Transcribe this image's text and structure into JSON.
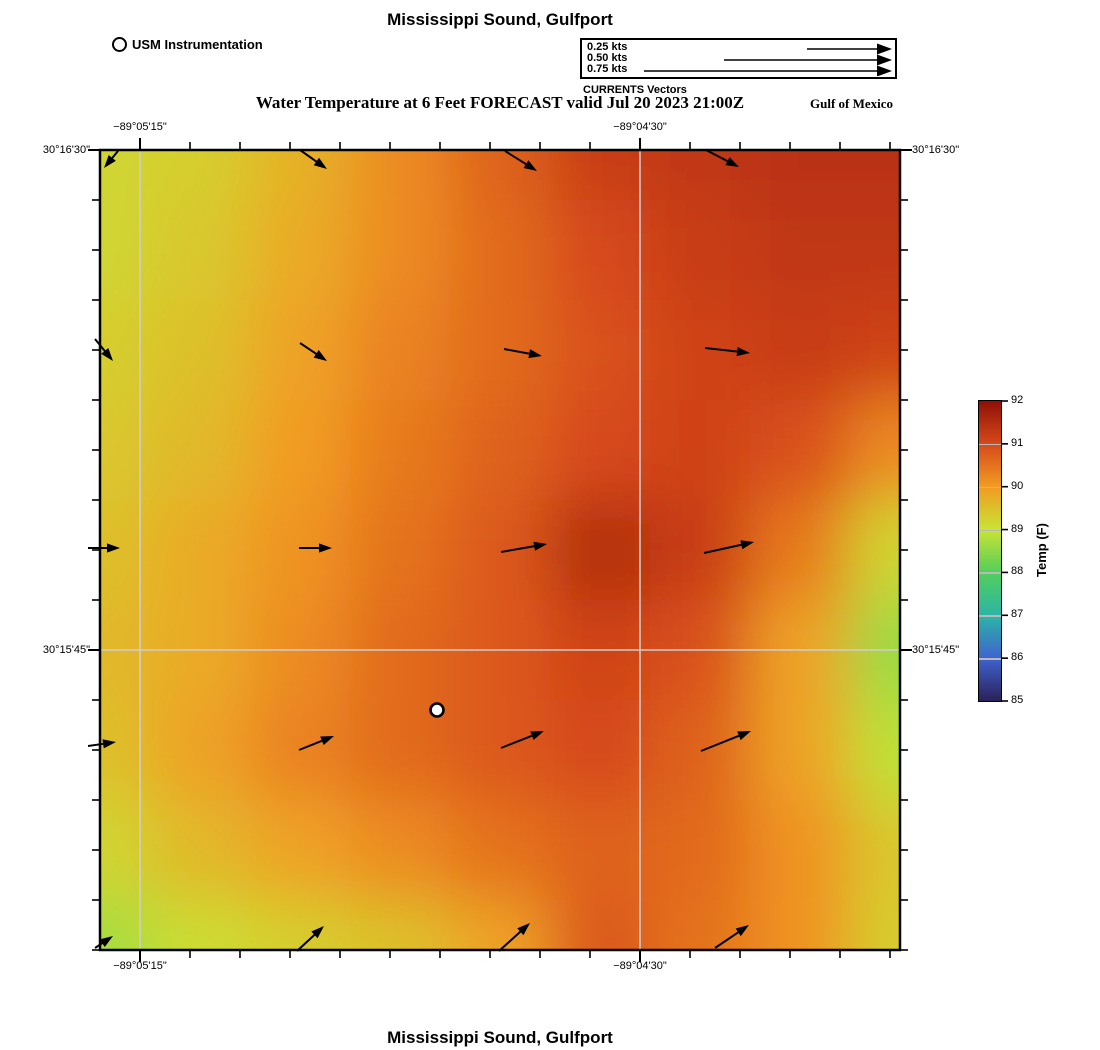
{
  "page": {
    "top_title": "Mississippi Sound, Gulfport",
    "subtitle": "Water Temperature at 6 Feet FORECAST valid Jul 20 2023 21:00Z",
    "gulf_label": "Gulf of Mexico",
    "bottom_title": "Mississippi Sound, Gulfport"
  },
  "station_legend": {
    "label": "USM Instrumentation"
  },
  "currents_legend": {
    "caption": "CURRENTS Vectors",
    "entries": [
      {
        "label": "0.25 kts",
        "tail_x": 225,
        "head_x": 310,
        "y": 9
      },
      {
        "label": "0.50 kts",
        "tail_x": 142,
        "head_x": 310,
        "y": 20
      },
      {
        "label": "0.75 kts",
        "tail_x": 62,
        "head_x": 310,
        "y": 31
      }
    ]
  },
  "axes": {
    "x_labels": [
      {
        "label": "−89°05'15\"",
        "px": 40
      },
      {
        "label": "−89°04'30\"",
        "px": 540
      }
    ],
    "y_labels": [
      {
        "label": "30°16'30\"",
        "px": 0
      },
      {
        "label": "30°15'45\"",
        "px": 500
      }
    ]
  },
  "chart_data": {
    "type": "heatmap",
    "title": "Water Temperature at 6 Feet FORECAST valid Jul 20 2023 21:00Z",
    "region": "Mississippi Sound, Gulfport",
    "units": "°F",
    "plot_px": 800,
    "grid_spacing_px": 100,
    "temperature_grid_F": [
      [
        89.2,
        89.3,
        89.7,
        90.2,
        90.7,
        91.2,
        91.3,
        91.4,
        91.4
      ],
      [
        89.2,
        89.4,
        89.8,
        90.2,
        90.6,
        91.0,
        91.2,
        91.3,
        91.3
      ],
      [
        89.3,
        89.5,
        89.9,
        90.3,
        90.6,
        90.9,
        91.1,
        91.2,
        91.1
      ],
      [
        89.4,
        89.6,
        90.0,
        90.4,
        90.7,
        91.0,
        91.1,
        90.9,
        90.2
      ],
      [
        89.5,
        89.8,
        90.1,
        90.5,
        90.8,
        91.5,
        91.2,
        90.4,
        89.2
      ],
      [
        89.6,
        89.8,
        90.2,
        90.6,
        90.8,
        91.1,
        90.9,
        89.9,
        88.6
      ],
      [
        89.5,
        89.9,
        90.3,
        90.6,
        90.8,
        91.0,
        90.7,
        89.9,
        88.9
      ],
      [
        89.2,
        89.6,
        89.9,
        90.2,
        90.5,
        90.7,
        90.6,
        90.1,
        89.4
      ],
      [
        88.7,
        89.1,
        89.3,
        89.5,
        89.9,
        90.8,
        90.5,
        90.1,
        89.3
      ]
    ],
    "colormap_stops": [
      [
        85,
        "#2b2158"
      ],
      [
        86,
        "#3f63cf"
      ],
      [
        87,
        "#2cb5a6"
      ],
      [
        88,
        "#54ce5b"
      ],
      [
        89,
        "#c8e434"
      ],
      [
        90,
        "#f29b23"
      ],
      [
        91,
        "#d6491a"
      ],
      [
        92,
        "#8e1006"
      ]
    ],
    "colorbar": {
      "label": "Temp (F)",
      "min": 85,
      "max": 92,
      "ticks": [
        92,
        91,
        90,
        89,
        88,
        87,
        86,
        85
      ]
    },
    "gridlines": {
      "x_px": [
        40,
        540
      ],
      "y_px": [
        500
      ]
    },
    "ticks": {
      "x_start": 40,
      "y_start": 0,
      "spacing": 50,
      "x_major": [
        40,
        540
      ],
      "y_major": [
        0,
        500
      ]
    },
    "station_marker": {
      "x": 337,
      "y": 560
    },
    "current_vectors_px": [
      {
        "x1": 18,
        "y1": 1,
        "x2": 4,
        "y2": 18
      },
      {
        "x1": 200,
        "y1": 0,
        "x2": 227,
        "y2": 19
      },
      {
        "x1": 405,
        "y1": 1,
        "x2": 437,
        "y2": 21
      },
      {
        "x1": 606,
        "y1": 0,
        "x2": 639,
        "y2": 17
      },
      {
        "x1": -5,
        "y1": 189,
        "x2": 13,
        "y2": 211
      },
      {
        "x1": 200,
        "y1": 193,
        "x2": 227,
        "y2": 211
      },
      {
        "x1": 404,
        "y1": 199,
        "x2": 442,
        "y2": 206
      },
      {
        "x1": 605,
        "y1": 198,
        "x2": 650,
        "y2": 203
      },
      {
        "x1": -12,
        "y1": 398,
        "x2": 20,
        "y2": 398
      },
      {
        "x1": 199,
        "y1": 398,
        "x2": 232,
        "y2": 398
      },
      {
        "x1": 401,
        "y1": 402,
        "x2": 447,
        "y2": 394
      },
      {
        "x1": 604,
        "y1": 403,
        "x2": 654,
        "y2": 392
      },
      {
        "x1": -12,
        "y1": 596,
        "x2": 16,
        "y2": 592
      },
      {
        "x1": 199,
        "y1": 600,
        "x2": 234,
        "y2": 586
      },
      {
        "x1": 401,
        "y1": 598,
        "x2": 444,
        "y2": 581
      },
      {
        "x1": 601,
        "y1": 601,
        "x2": 651,
        "y2": 581
      },
      {
        "x1": -5,
        "y1": 798,
        "x2": 13,
        "y2": 786
      },
      {
        "x1": 197,
        "y1": 801,
        "x2": 224,
        "y2": 776
      },
      {
        "x1": 399,
        "y1": 801,
        "x2": 430,
        "y2": 773
      },
      {
        "x1": 615,
        "y1": 798,
        "x2": 649,
        "y2": 775
      }
    ]
  }
}
